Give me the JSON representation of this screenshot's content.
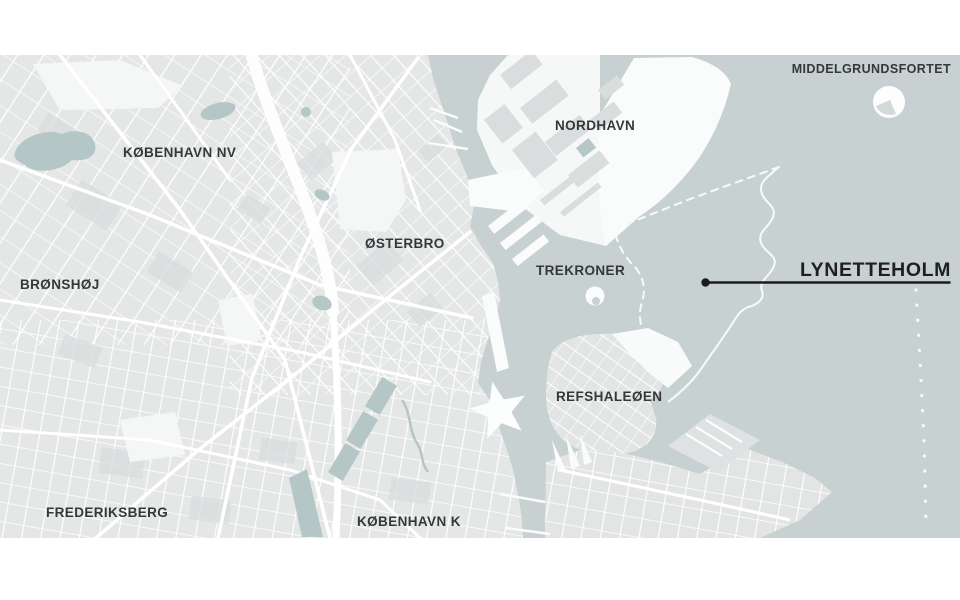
{
  "map": {
    "region_labels": [
      {
        "id": "kobenhavn-nv",
        "text": "KØBENHAVN NV"
      },
      {
        "id": "bronshoj",
        "text": "BRØNSHØJ"
      },
      {
        "id": "osterbro",
        "text": "ØSTERBRO"
      },
      {
        "id": "nordhavn",
        "text": "NORDHAVN"
      },
      {
        "id": "middelgrundsfortet",
        "text": "MIDDELGRUNDSFORTET"
      },
      {
        "id": "trekroner",
        "text": "TREKRONER"
      },
      {
        "id": "refshaleoen",
        "text": "REFSHALEØEN"
      },
      {
        "id": "frederiksberg",
        "text": "FREDERIKSBERG"
      },
      {
        "id": "kobenhavn-k",
        "text": "KØBENHAVN K"
      }
    ],
    "callout": {
      "text": "LYNETTEHOLM"
    },
    "colors": {
      "water": "#c7d1d1",
      "land": "#e5e7e7",
      "land_block": "#d9dddd",
      "street": "#ffffff",
      "park": "#b5c6c7",
      "label_text": "#35383b",
      "callout_line": "#1d1d1b",
      "island": "#fdfdfd",
      "boundary": "#f7fafa"
    }
  }
}
